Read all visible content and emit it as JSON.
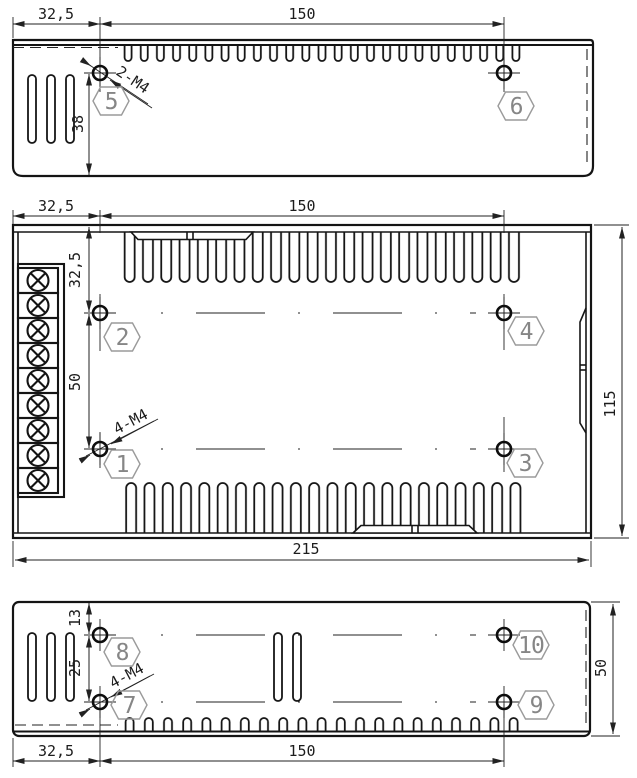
{
  "drawing": {
    "kind": "enclosure-dimensional-drawing",
    "units": "mm",
    "colors": {
      "line": "#141414",
      "annotation_gray": "#9a9a9a",
      "background": "#ffffff"
    }
  },
  "views": {
    "top": {
      "dim_left": "32,5",
      "dim_center": "150",
      "dim_height": "38",
      "thread_label": "2-M4",
      "callouts": {
        "c5": "5",
        "c6": "6"
      }
    },
    "main": {
      "dim_left_top": "32,5",
      "dim_center_top": "150",
      "dim_offset_left": "32,5",
      "dim_spacing_left": "50",
      "dim_depth": "115",
      "dim_width": "215",
      "thread_label": "4-M4",
      "terminal_count": "9",
      "callouts": {
        "c1": "1",
        "c2": "2",
        "c3": "3",
        "c4": "4"
      }
    },
    "bottom": {
      "dim_offset_top": "13",
      "dim_spacing": "25",
      "dim_height": "50",
      "dim_left": "32,5",
      "dim_center": "150",
      "thread_label": "4-M4",
      "callouts": {
        "c7": "7",
        "c8": "8",
        "c9": "9",
        "c10": "10"
      }
    }
  }
}
